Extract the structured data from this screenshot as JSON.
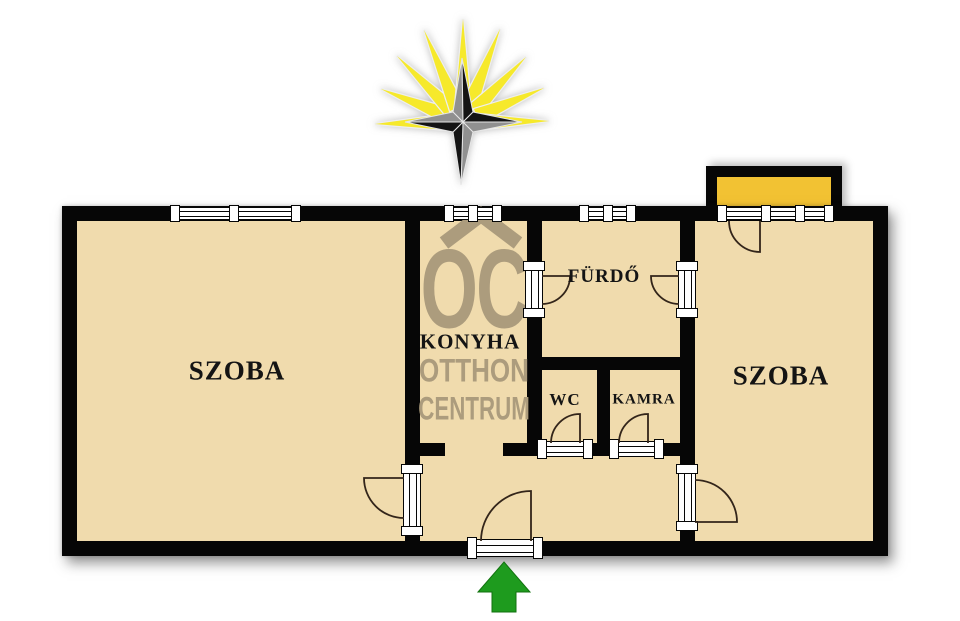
{
  "plan": {
    "type": "apartment-floor-plan",
    "rooms": [
      {
        "id": "room-left",
        "label": "SZOBA"
      },
      {
        "id": "kitchen",
        "label": "KONYHA"
      },
      {
        "id": "bathroom",
        "label": "FÜRDŐ"
      },
      {
        "id": "wc",
        "label": "WC"
      },
      {
        "id": "pantry",
        "label": "KAMRA"
      },
      {
        "id": "room-right",
        "label": "SZOBA"
      }
    ],
    "watermark": {
      "logo": "OC",
      "line1": "OTTHON",
      "line2": "CENTRUM"
    },
    "icons": [
      {
        "name": "compass-star-icon",
        "meaning": "north orientation star with sun rays"
      },
      {
        "name": "entrance-arrow-icon",
        "meaning": "main entrance direction"
      },
      {
        "name": "balcony",
        "meaning": "balcony at top right room"
      }
    ],
    "colors": {
      "floor": "#F0DBAD",
      "wall": "#060606",
      "balcony_fill": "#F2C233",
      "entrance_arrow": "#1E9B1E",
      "compass_ray_yellow": "#F6E92B",
      "compass_star_black": "#141414",
      "compass_star_gray": "#909090",
      "watermark": "#AC9C7D",
      "frame_white": "#FFFFFF"
    }
  }
}
